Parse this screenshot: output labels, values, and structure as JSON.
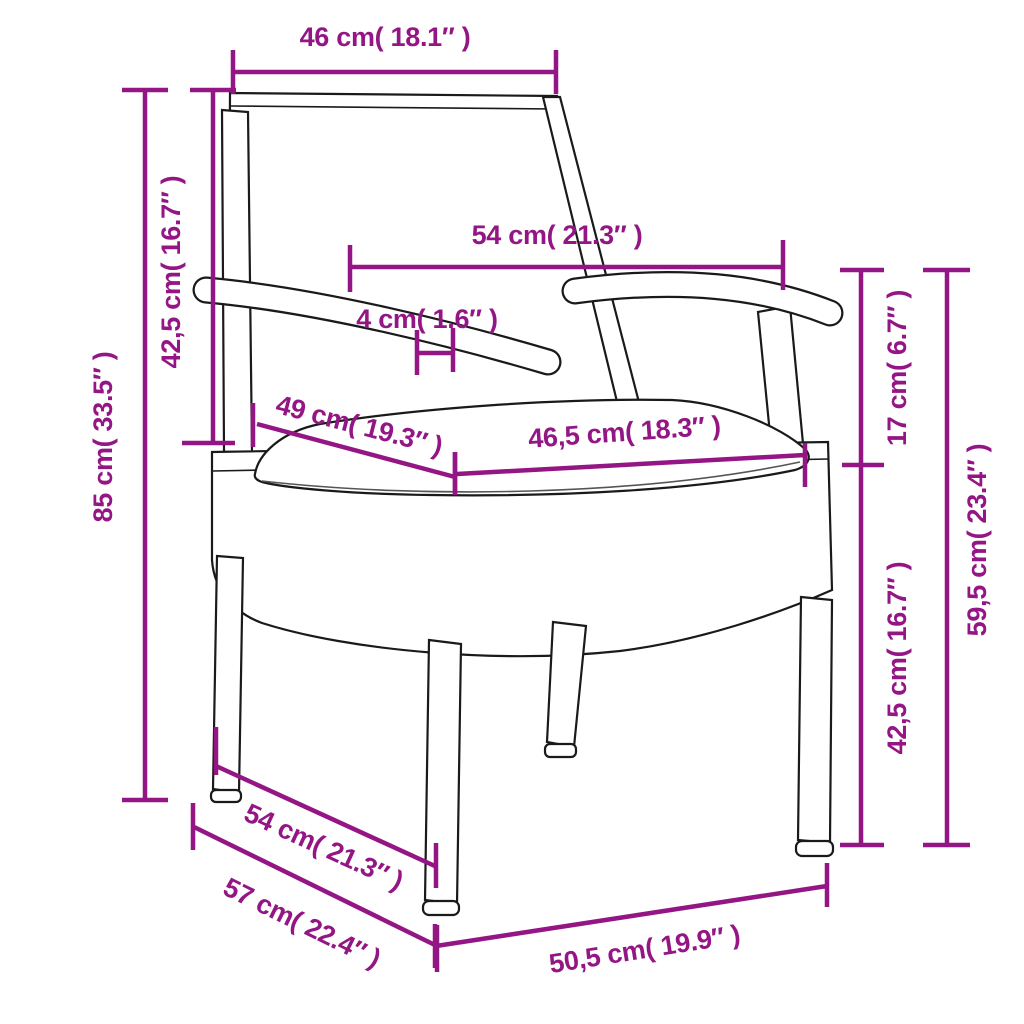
{
  "image_type": "product-dimension-diagram",
  "subject": "rattan garden chair with cushion",
  "colors": {
    "accent": "#941685",
    "outline": "#1a1a1a",
    "cushion": "#fdfdfd",
    "background": "#ffffff"
  },
  "measurements": {
    "top_width": "46 cm( 18.1″ )",
    "backrest_height": "42,5 cm( 16.7″ )",
    "total_height": "85 cm( 33.5″ )",
    "armrest_span": "54 cm( 21.3″ )",
    "armrest_thickness": "4 cm( 1.6″ )",
    "seat_depth": "49 cm( 19.3″ )",
    "cushion_width": "46,5 cm( 18.3″ )",
    "arm_above_seat": "17 cm( 6.7″ )",
    "seat_height": "42,5 cm( 16.7″ )",
    "arm_height": "59,5 cm( 23.4″ )",
    "base_depth_top": "54 cm( 21.3″ )",
    "base_depth_bottom": "57 cm( 22.4″ )",
    "base_width": "50,5 cm( 19.9″ )"
  }
}
